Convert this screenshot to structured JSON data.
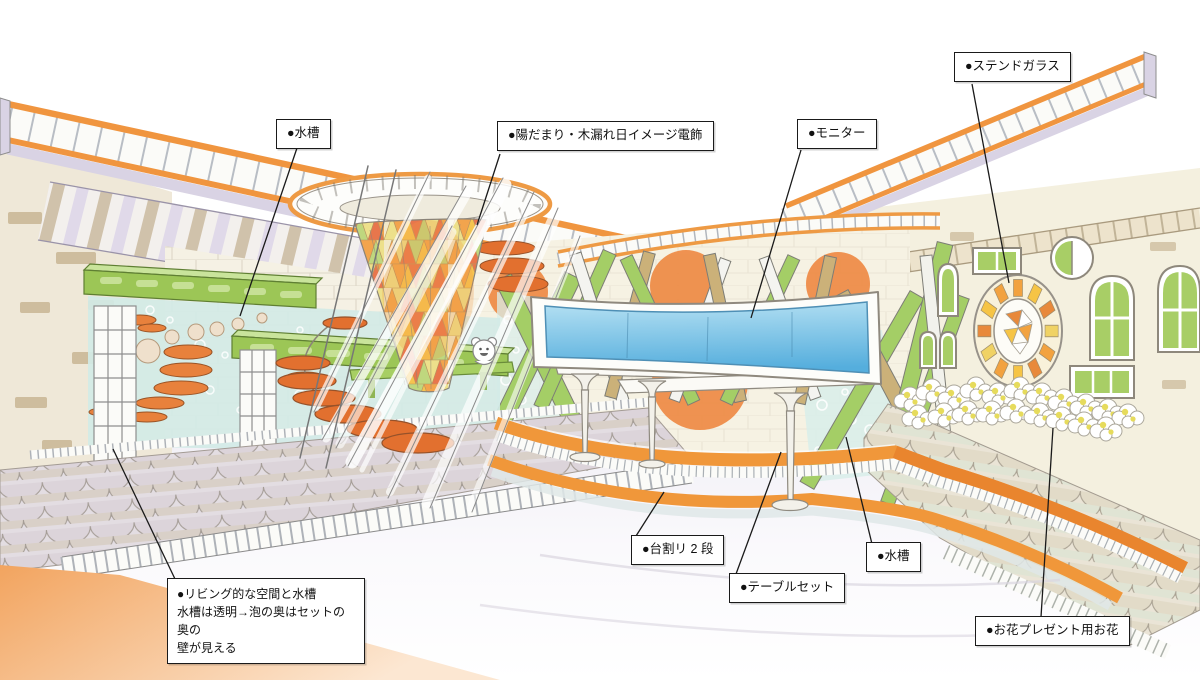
{
  "labels": {
    "aquarium_top": "●水槽",
    "sunlight": "●陽だまり・木漏れ日イメージ電飾",
    "monitor": "●モニター",
    "stained_glass": "●ステンドガラス",
    "living_line1": "●リビング的な空間と水槽",
    "living_line2": "水槽は透明→泡の奥はセットの奥の",
    "living_line3": "壁が見える",
    "stage_two_tiers": "●台割リ 2 段",
    "table_set": "●テーブルセット",
    "aquarium_right": "●水槽",
    "gift_flowers": "●お花プレゼント用お花"
  },
  "colors": {
    "accent_orange": "#F0953F",
    "disc_orange": "#E2702F",
    "beam_green": "#9CC656",
    "strut_tan": "#CBB179",
    "water_teal": "#D3EAE6",
    "monitor_blue": "#5FB6E3",
    "wall_cream": "#F4F0DF",
    "roof_lavender": "#DDD6E8",
    "stained_glass_orange": "#F2A23F",
    "flower_yellow": "#E6DB5C"
  }
}
